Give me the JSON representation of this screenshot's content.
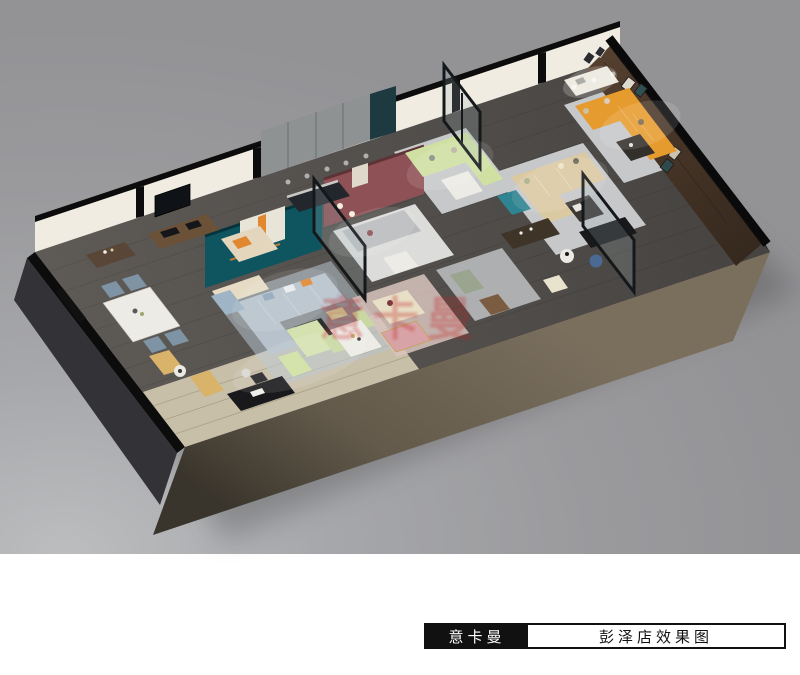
{
  "title_bar": {
    "brand": "意卡曼",
    "store_title": "彭泽店效果图"
  },
  "watermark": {
    "text": "意卡曼"
  },
  "palette": {
    "canvas-gray": "#9a9a9d",
    "canvas-gray-light": "#bcbdbf",
    "page-white": "#ffffff",
    "floor-dark": "#53504d",
    "floor-darker": "#474441",
    "light-wood": "#c8bfa9",
    "wall-white": "#f0ece2",
    "wall-black": "#0c0c0c",
    "front-wall-brown": "#6e6455",
    "front-wall-brown-dark": "#3a352c",
    "side-wall-gray": "#333236",
    "teal-wall": "#0e5560",
    "maroon-wall": "#8e5156",
    "wood-wall": "#4a382b",
    "cabinet-gray": "#8f9292",
    "tv-panel": "#1c3a40",
    "sofa-blue": "#b7c2cc",
    "sofa-tan": "#dbc9a2",
    "sofa-orange": "#e69b2e",
    "sofa-green": "#cfe0a2",
    "sofa-gray": "#b9bcbe",
    "sofa-cream": "#e7dfc6",
    "accent-orange": "#e0872f",
    "rug-gray": "#c6c8ca",
    "rug-white": "#dcdcda",
    "rug-pink": "#d8c3bd",
    "table-white": "#edebe6",
    "desk-black": "#19191b",
    "pink-cabinet": "#d8a3a6",
    "ottoman-blue": "#4a6a94",
    "chair-tan": "#d9b36a",
    "armchair-teal": "#2e8491",
    "glass-tint": "#9fb3b8",
    "watermark-red": "#c42222"
  }
}
